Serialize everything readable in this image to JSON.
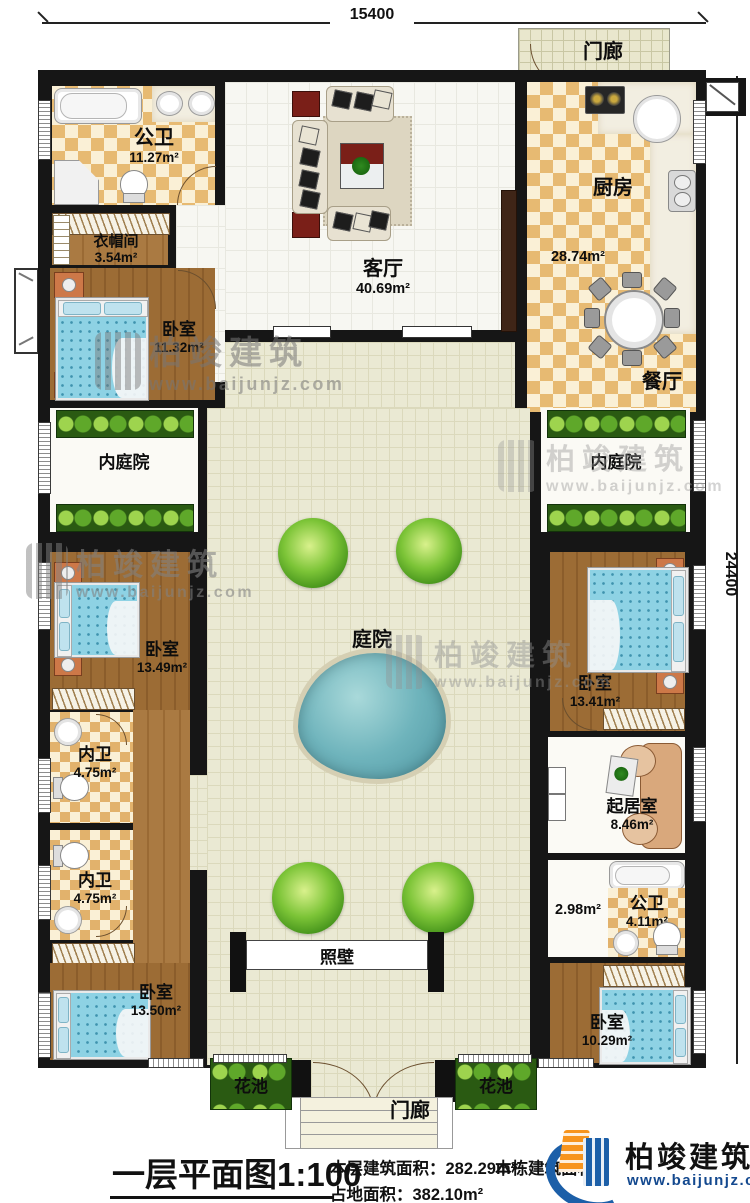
{
  "dimensions": {
    "top": "15400",
    "right": "24400"
  },
  "rooms": {
    "menlang_top": {
      "name": "门廊"
    },
    "gongwei1": {
      "name": "公卫",
      "area": "11.27m²"
    },
    "yimaojian": {
      "name": "衣帽间",
      "area": "3.54m²"
    },
    "keting": {
      "name": "客厅",
      "area": "40.69m²"
    },
    "chufang": {
      "name": "厨房",
      "area": "28.74m²"
    },
    "canting": {
      "name": "餐厅"
    },
    "woshi1": {
      "name": "卧室",
      "area": "11.32m²"
    },
    "neitingyuan_left": {
      "name": "内庭院"
    },
    "neitingyuan_right": {
      "name": "内庭院"
    },
    "tingyuan": {
      "name": "庭院"
    },
    "woshi2": {
      "name": "卧室",
      "area": "13.49m²"
    },
    "woshi3": {
      "name": "卧室",
      "area": "13.41m²"
    },
    "neiwei1": {
      "name": "内卫",
      "area": "4.75m²"
    },
    "neiwei2": {
      "name": "内卫",
      "area": "4.75m²"
    },
    "qijushi": {
      "name": "起居室",
      "area": "8.46m²"
    },
    "guodao": {
      "area": "2.98m²"
    },
    "gongwei2": {
      "name": "公卫",
      "area": "4.11m²"
    },
    "woshi4": {
      "name": "卧室",
      "area": "13.50m²"
    },
    "woshi5": {
      "name": "卧室",
      "area": "10.29m²"
    },
    "zhaobi": {
      "name": "照壁"
    },
    "huachi_left": {
      "name": "花池"
    },
    "huachi_right": {
      "name": "花池"
    },
    "menlang_bottom": {
      "name": "门廊"
    }
  },
  "watermark": {
    "brand": "柏竣建筑",
    "site": "www.baijunjz.com"
  },
  "footer": {
    "title": "一层平面图",
    "scale": "1:100",
    "floor_area_label": "本层建筑面积：",
    "floor_area_value": "282.29m²",
    "land_area_label": "占地面积：",
    "land_area_value": "382.10m²",
    "building_area_label": "本栋建筑面积：",
    "brand": "柏竣建筑",
    "site": "www.baijunjz.com"
  },
  "colors": {
    "wall": "#161616",
    "water": "#5fa8b0",
    "plant": "#5fae22",
    "logo_blue": "#1c5fa8",
    "logo_orange": "#f7941d",
    "accent_red": "#7a1f18"
  }
}
